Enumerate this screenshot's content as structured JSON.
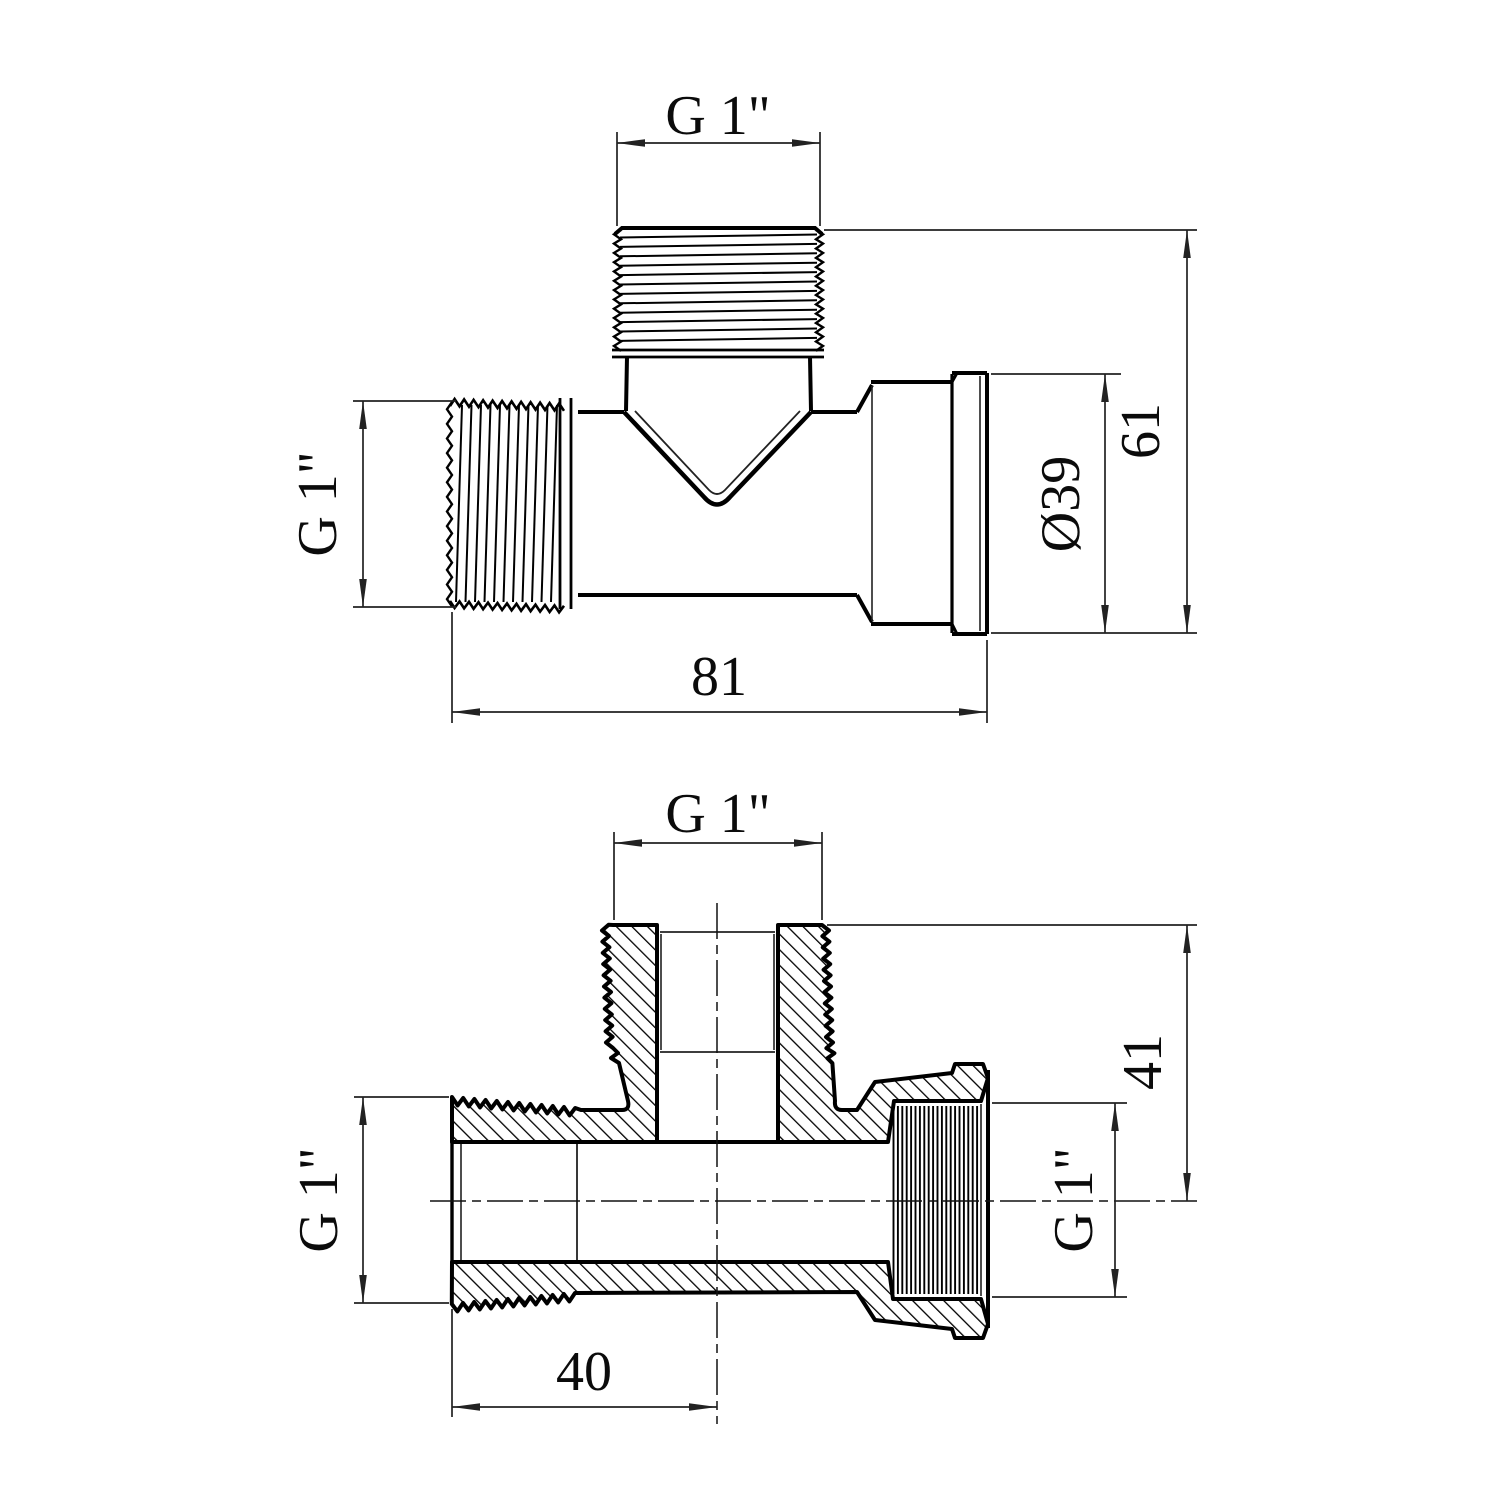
{
  "drawing": {
    "type": "technical-drawing",
    "subject": "G1 tee pipe fitting, two orthographic views",
    "background_color": "#ffffff",
    "outline_color": "#000000",
    "dimension_color": "#222222",
    "views": {
      "top_view": {
        "name": "external view",
        "dims": {
          "branch_thread": "G 1\"",
          "left_thread": "G 1\"",
          "socket_diameter": "Ø39",
          "overall_height": "61",
          "body_length": "81"
        }
      },
      "section_view": {
        "name": "cross-section view",
        "dims": {
          "branch_thread": "G 1\"",
          "left_thread": "G 1\"",
          "right_thread": "G 1\"",
          "branch_height_to_axis": "41",
          "left_port_length": "40"
        }
      }
    }
  }
}
